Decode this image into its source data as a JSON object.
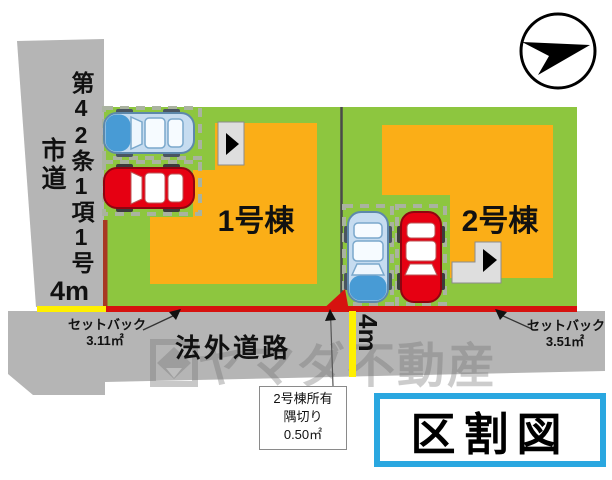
{
  "diagram_title": "区割図",
  "left_road": {
    "regulation": "第42条1項1号",
    "name": "市道",
    "width_label": "4m"
  },
  "bottom_road": {
    "name": "法外道路",
    "width_label": "4m"
  },
  "lot1": {
    "label": "1号棟",
    "setback_label": "セットバック",
    "setback_area": "3.11㎡"
  },
  "lot2": {
    "label": "2号棟",
    "setback_label": "セットバック",
    "setback_area": "3.51㎡"
  },
  "corner_cut": {
    "owner": "2号棟所有",
    "type": "隅切り",
    "area": "0.50㎡"
  },
  "watermark": {
    "text": "ヤマダ不動産"
  },
  "icons": {
    "compass": "north-arrow-icon",
    "entrance": "entrance-arrow-icon"
  },
  "colors": {
    "lot_green": "#8dc63f",
    "building_yellow": "#fbae17",
    "road_gray": "#b5b5b5",
    "setback_red": "#d6120f",
    "setback_dark_red": "#a83823",
    "road_width_yellow": "#fff000",
    "title_border_blue": "#2aa7e0",
    "car_blue": "#489bd5",
    "car_red": "#e60012"
  }
}
